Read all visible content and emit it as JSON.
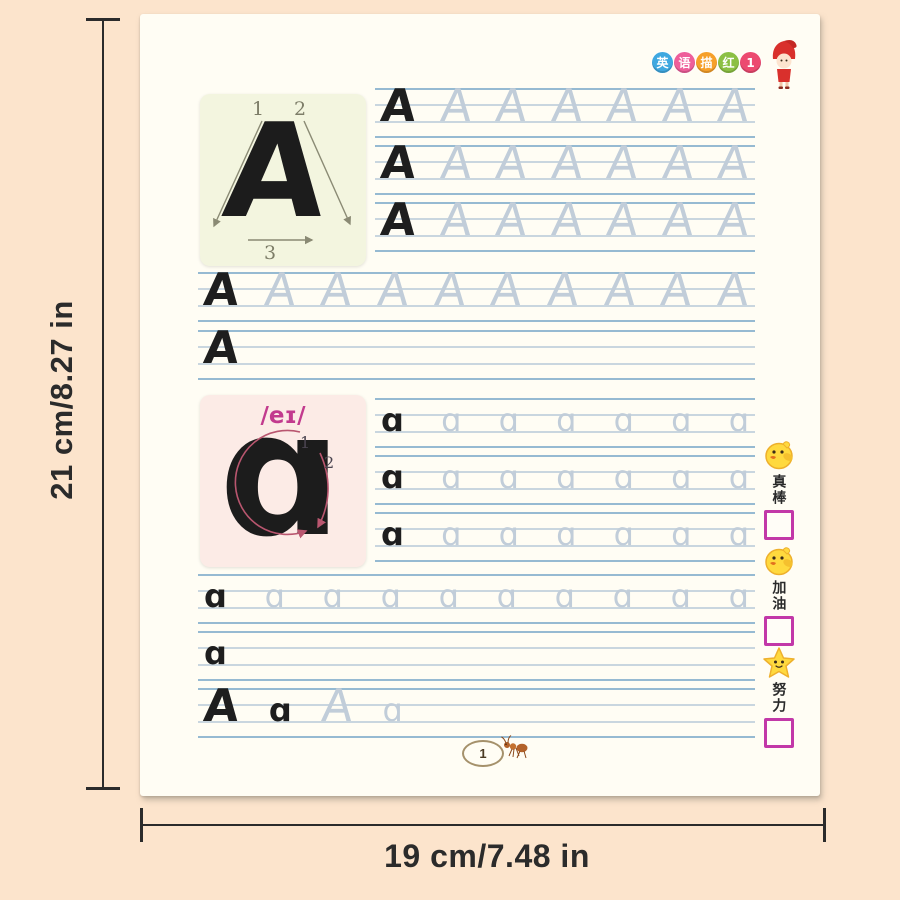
{
  "annotations": {
    "height_label": "21 cm/8.27 in",
    "width_label": "19 cm/7.48 in"
  },
  "header": {
    "logo_badges": [
      {
        "char": "英",
        "color": "#3fa8e0"
      },
      {
        "char": "语",
        "color": "#ee5f9a"
      },
      {
        "char": "描",
        "color": "#f6a02a"
      },
      {
        "char": "红",
        "color": "#8cc044"
      },
      {
        "char": "1",
        "color": "#ec4a70"
      }
    ],
    "mascot": "red-hood-girl"
  },
  "uppercase_card": {
    "letter": "A",
    "stroke_numbers": [
      "1",
      "2",
      "3"
    ]
  },
  "lowercase_card": {
    "letter": "a",
    "phonetic": "/eɪ/",
    "stroke_numbers": [
      "1",
      "2"
    ]
  },
  "practice_rows": [
    {
      "letters": [
        {
          "ch": "A",
          "solid": true
        },
        {
          "ch": "A",
          "solid": false
        },
        {
          "ch": "A",
          "solid": false
        },
        {
          "ch": "A",
          "solid": false
        },
        {
          "ch": "A",
          "solid": false
        },
        {
          "ch": "A",
          "solid": false
        },
        {
          "ch": "A",
          "solid": false
        }
      ]
    },
    {
      "letters": [
        {
          "ch": "A",
          "solid": true
        },
        {
          "ch": "A",
          "solid": false
        },
        {
          "ch": "A",
          "solid": false
        },
        {
          "ch": "A",
          "solid": false
        },
        {
          "ch": "A",
          "solid": false
        },
        {
          "ch": "A",
          "solid": false
        },
        {
          "ch": "A",
          "solid": false
        }
      ]
    },
    {
      "letters": [
        {
          "ch": "A",
          "solid": true
        },
        {
          "ch": "A",
          "solid": false
        },
        {
          "ch": "A",
          "solid": false
        },
        {
          "ch": "A",
          "solid": false
        },
        {
          "ch": "A",
          "solid": false
        },
        {
          "ch": "A",
          "solid": false
        },
        {
          "ch": "A",
          "solid": false
        }
      ]
    },
    {
      "letters": [
        {
          "ch": "A",
          "solid": true
        },
        {
          "ch": "A",
          "solid": false
        },
        {
          "ch": "A",
          "solid": false
        },
        {
          "ch": "A",
          "solid": false
        },
        {
          "ch": "A",
          "solid": false
        },
        {
          "ch": "A",
          "solid": false
        },
        {
          "ch": "A",
          "solid": false
        },
        {
          "ch": "A",
          "solid": false
        },
        {
          "ch": "A",
          "solid": false
        },
        {
          "ch": "A",
          "solid": false
        }
      ]
    },
    {
      "letters": [
        {
          "ch": "A",
          "solid": true
        }
      ]
    },
    {
      "letters": [
        {
          "ch": "a",
          "solid": true
        },
        {
          "ch": "a",
          "solid": false
        },
        {
          "ch": "a",
          "solid": false
        },
        {
          "ch": "a",
          "solid": false
        },
        {
          "ch": "a",
          "solid": false
        },
        {
          "ch": "a",
          "solid": false
        },
        {
          "ch": "a",
          "solid": false
        }
      ]
    },
    {
      "letters": [
        {
          "ch": "a",
          "solid": true
        },
        {
          "ch": "a",
          "solid": false
        },
        {
          "ch": "a",
          "solid": false
        },
        {
          "ch": "a",
          "solid": false
        },
        {
          "ch": "a",
          "solid": false
        },
        {
          "ch": "a",
          "solid": false
        },
        {
          "ch": "a",
          "solid": false
        }
      ]
    },
    {
      "letters": [
        {
          "ch": "a",
          "solid": true
        },
        {
          "ch": "a",
          "solid": false
        },
        {
          "ch": "a",
          "solid": false
        },
        {
          "ch": "a",
          "solid": false
        },
        {
          "ch": "a",
          "solid": false
        },
        {
          "ch": "a",
          "solid": false
        },
        {
          "ch": "a",
          "solid": false
        }
      ]
    },
    {
      "letters": [
        {
          "ch": "a",
          "solid": true
        },
        {
          "ch": "a",
          "solid": false
        },
        {
          "ch": "a",
          "solid": false
        },
        {
          "ch": "a",
          "solid": false
        },
        {
          "ch": "a",
          "solid": false
        },
        {
          "ch": "a",
          "solid": false
        },
        {
          "ch": "a",
          "solid": false
        },
        {
          "ch": "a",
          "solid": false
        },
        {
          "ch": "a",
          "solid": false
        },
        {
          "ch": "a",
          "solid": false
        }
      ]
    },
    {
      "letters": [
        {
          "ch": "a",
          "solid": true
        }
      ]
    },
    {
      "letters": [
        {
          "ch": "A",
          "solid": true
        },
        {
          "ch": "a",
          "solid": true
        },
        {
          "ch": "A",
          "solid": false
        },
        {
          "ch": "a",
          "solid": false
        }
      ]
    }
  ],
  "reward_badges": [
    {
      "icon": "chick-icon",
      "label": "真棒"
    },
    {
      "icon": "chick-icon",
      "label": "加油"
    },
    {
      "icon": "star-icon",
      "label": "努力"
    }
  ],
  "footer": {
    "page_number": "1",
    "mascot": "ant"
  },
  "colors": {
    "background": "#fce4cc",
    "page": "#fffdf4",
    "guide_line_outer": "#96bad2",
    "guide_line_inner": "#c9d6df",
    "trace_letter": "#c1cdd9",
    "solid_letter": "#1e1e1e",
    "checkbox": "#c238a8",
    "phonetic": "#c23a8e",
    "uppercase_card_bg": "#f3f5df",
    "lowercase_card_bg": "#fcebe6"
  }
}
